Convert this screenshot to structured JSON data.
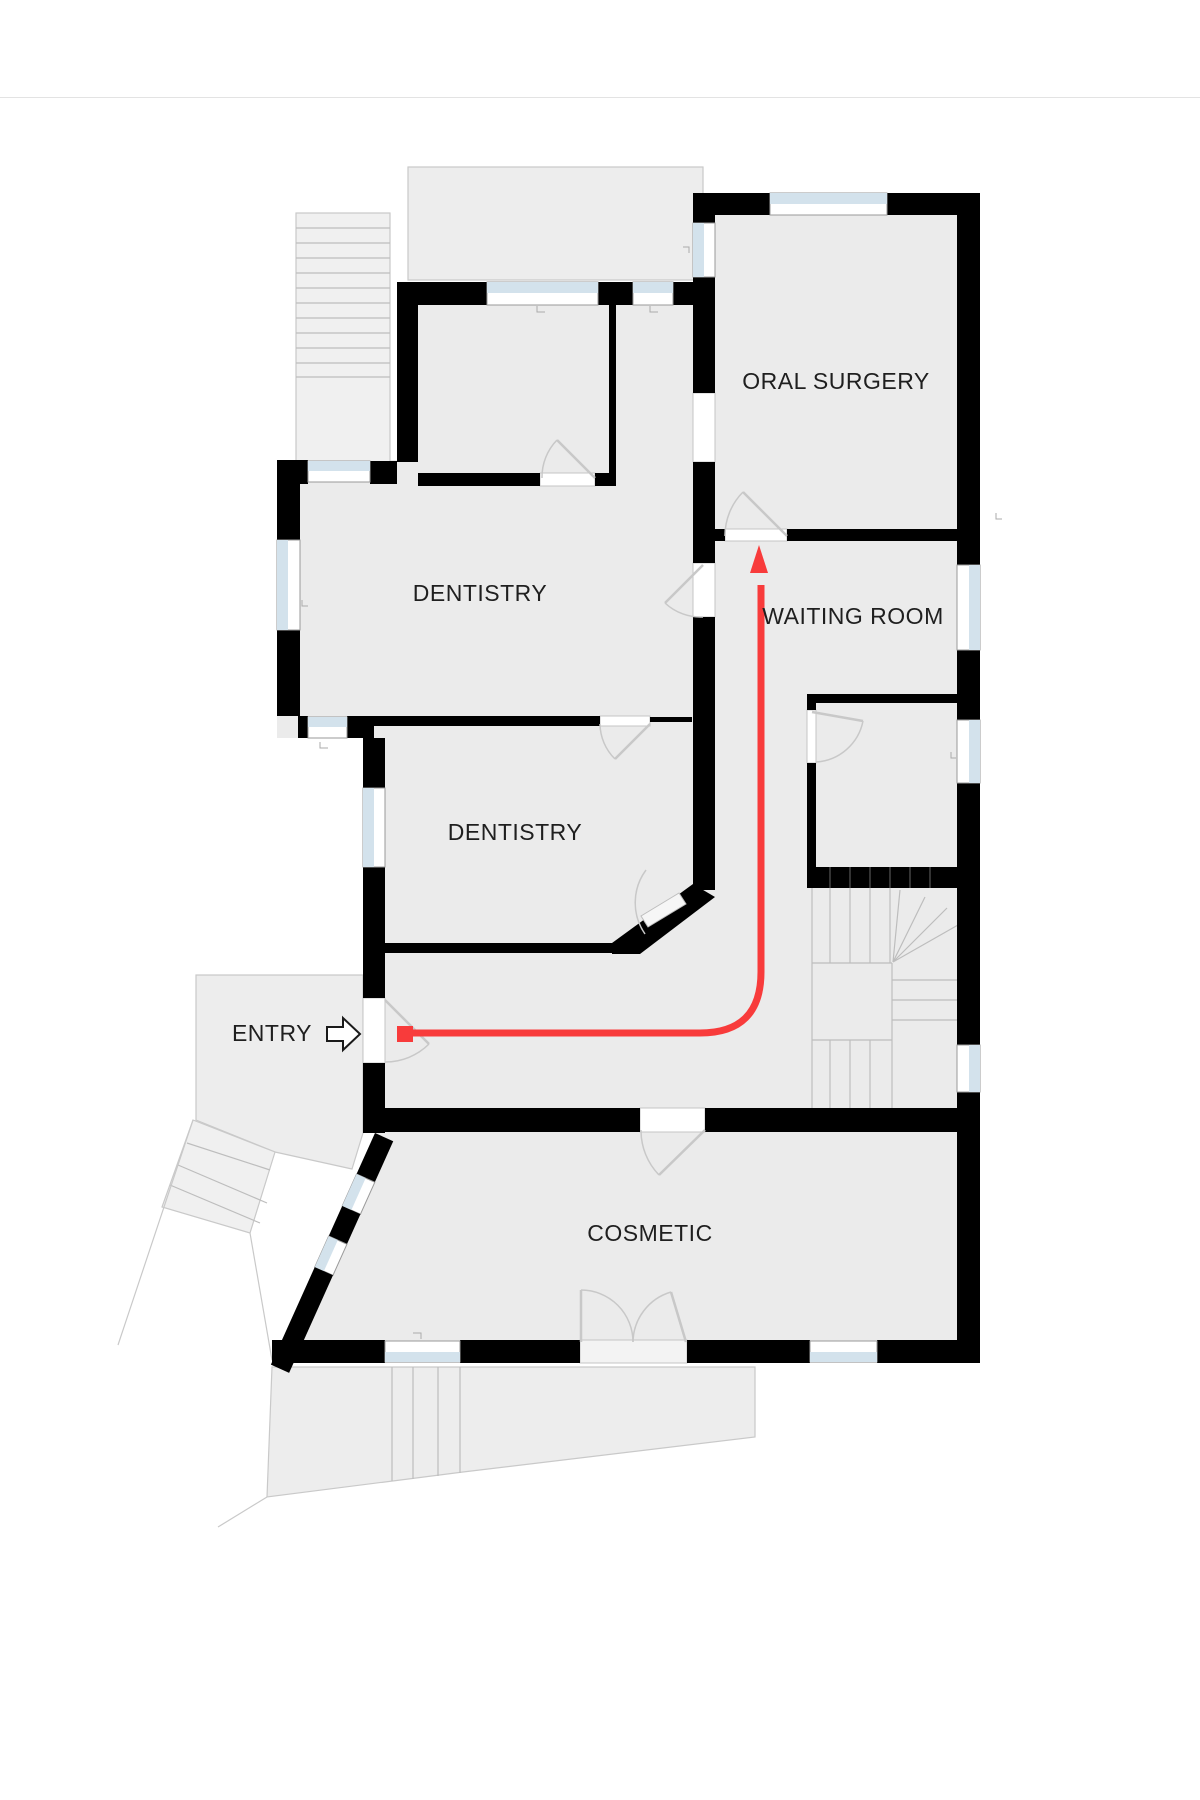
{
  "theme": {
    "wall": "#000000",
    "floor": "#ebebeb",
    "outdoor": "#ededed",
    "outdoor_line": "#c9c9c9",
    "stair_fill": "#f0f0f0",
    "stair_line": "#bdbdbd",
    "glass": "#d3e2ec",
    "window_frame": "#9a9a9a",
    "door": "#c8c8c8",
    "leaf_fill": "#f6f6f6",
    "text": "#1f1f1f",
    "divider": "#e3e3e3",
    "route": "#f83b3b"
  },
  "floorplan": {
    "rooms": [
      {
        "name": "oral-surgery",
        "label": "ORAL SURGERY"
      },
      {
        "name": "waiting-room",
        "label": "WAITING ROOM"
      },
      {
        "name": "dentistry-upper",
        "label": "DENTISTRY"
      },
      {
        "name": "dentistry-lower",
        "label": "DENTISTRY"
      },
      {
        "name": "entry",
        "label": "ENTRY"
      },
      {
        "name": "cosmetic",
        "label": "COSMETIC"
      }
    ],
    "route": {
      "description": "red path from entry door to oral surgery door",
      "path_d": "M 413 1033 L 700 1033 Q 761 1033 761 972 L 761 585",
      "start": {
        "x": 405,
        "y": 1034
      },
      "arrow_points": "759,545 750,573 768,573"
    }
  }
}
